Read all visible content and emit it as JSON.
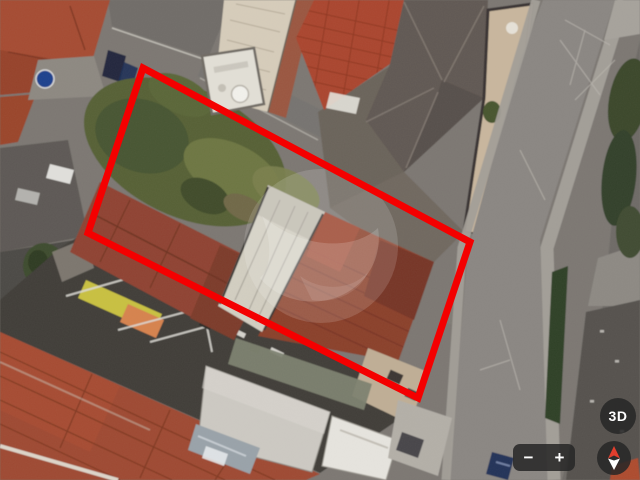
{
  "map": {
    "view_type": "satellite-aerial",
    "description": "Aerial satellite view of an urban residential block; a property lot is outlined with a red boundary; translucent circular logo watermark in the center",
    "lot_outline": {
      "points_str": "143,68 470,242 418,398 88,233",
      "color": "#f40000",
      "stroke_width": 7
    },
    "watermark": {
      "name": "listing-site-logo-watermark",
      "color": "#ffffff",
      "opacity": 0.16
    }
  },
  "controls": {
    "tilt_button_label": "3D",
    "zoom_out_label": "−",
    "zoom_in_label": "+",
    "compass": {
      "north_color": "#e03e2d",
      "south_color": "#ffffff"
    },
    "button_background": "rgba(38,38,38,0.86)"
  },
  "scene_palette": {
    "asphalt": "#8a8682",
    "top_street": "#6f6c68",
    "sidewalk": "#a29e97",
    "terracotta_roof": "#a54b31",
    "dark_red_roof": "#8a3f2b",
    "bottom_red_roof": "#9e4830",
    "vegetation": "#566135",
    "trees": "#3a462c",
    "hip_roof_gray": "#615853",
    "tan_building": "#d6ccba",
    "courtyard_beige": "#c8b69d",
    "white_roof": "#d2cec1",
    "concrete_slab": "#ccc9c2",
    "charcoal_yard": "#3f3c39",
    "yellow_object": "#c8c041",
    "orange_object": "#d6824e",
    "blue_tank": "#1f3f8d",
    "car_blue": "#233058"
  }
}
